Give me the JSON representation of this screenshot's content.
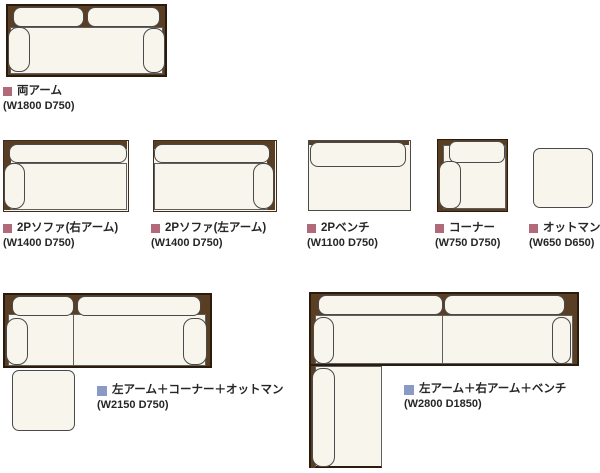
{
  "diagram_title": "sofa-module-lineup",
  "colors": {
    "wood": "#5a3e24",
    "wood_border": "#2a1b0d",
    "cushion": "#f7f5ec",
    "cushion_border": "#4a4a4a",
    "bullet_single": "#b2697a",
    "bullet_combo": "#8b9ac5",
    "text": "#262626"
  },
  "items": [
    {
      "id": "both-arms",
      "label": "両アーム",
      "dims": "(W1800 D750)"
    },
    {
      "id": "sofa-2p-right-arm",
      "label": "2Pソファ(右アーム)",
      "dims": "(W1400 D750)"
    },
    {
      "id": "sofa-2p-left-arm",
      "label": "2Pソファ(左アーム)",
      "dims": "(W1400 D750)"
    },
    {
      "id": "bench-2p",
      "label": "2Pベンチ",
      "dims": "(W1100 D750)"
    },
    {
      "id": "corner",
      "label": "コーナー",
      "dims": "(W750 D750)"
    },
    {
      "id": "ottoman",
      "label": "オットマン",
      "dims": "(W650 D650)"
    },
    {
      "id": "combo-leftarm-corner-ottoman",
      "label": "左アーム＋コーナー＋オットマン",
      "dims": "(W2150 D750)"
    },
    {
      "id": "combo-leftarm-rightarm-bench",
      "label": "左アーム＋右アーム＋ベンチ",
      "dims": "(W2800 D1850)"
    }
  ]
}
